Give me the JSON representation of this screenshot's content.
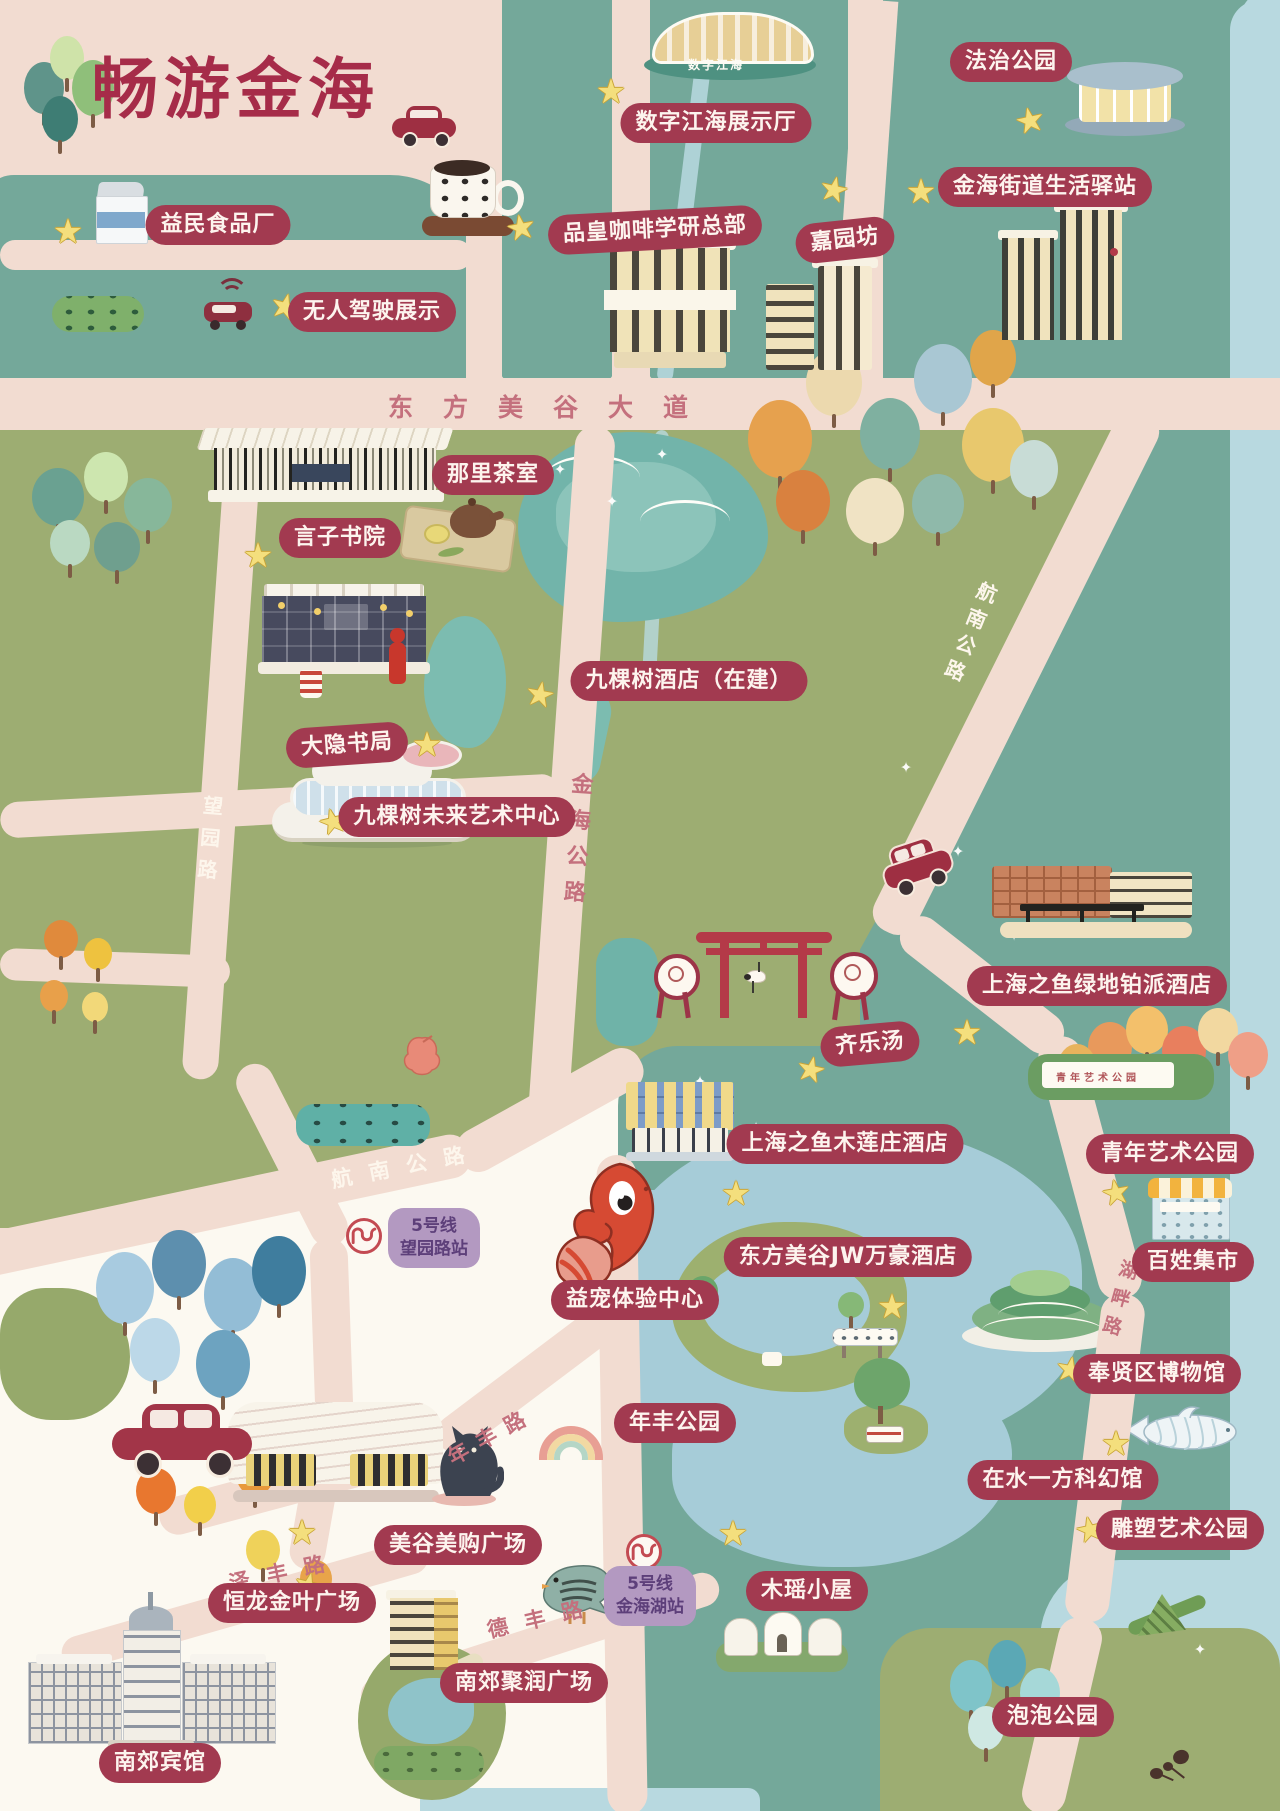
{
  "title": "畅游金海",
  "colors": {
    "background_pink": "#f2dcd1",
    "block_teal": "#74a89a",
    "block_olive": "#9dad72",
    "water_light": "#b8d9e0",
    "lake_blue": "#a6ccd8",
    "label_red": "#a23a50",
    "label_text": "#fdf4ee",
    "road_text_red": "#c4707d",
    "road_text_white": "#fdf6ec",
    "star_yellow": "#f4df7d",
    "metro_purple": "#b399c1",
    "title_red": "#a62c49"
  },
  "icons": {
    "star": "★",
    "sparkle": "✦"
  },
  "pois": {
    "yimin": "益民食品厂",
    "wuren": "无人驾驶展示",
    "shuzi": "数字江海展示厅",
    "pinhuang": "品皇咖啡学研总部",
    "jiayuanfang": "嘉园坊",
    "fazhi": "法治公园",
    "yizhan": "金海街道生活驿站",
    "nali": "那里茶室",
    "yanzi": "言子书院",
    "jiukeshu_hotel": "九棵树酒店（在建）",
    "dayin": "大隐书局",
    "jiukeshu_art": "九棵树未来艺术中心",
    "lvdi_hotel": "上海之鱼绿地铂派酒店",
    "qiletang": "齐乐汤",
    "mulianzhuang": "上海之鱼木莲庄酒店",
    "jw": "东方美谷JW万豪酒店",
    "qingnian": "青年艺术公园",
    "baixing": "百姓集市",
    "yichong": "益宠体验中心",
    "bowuguan": "奉贤区博物馆",
    "nianfeng_park": "年丰公园",
    "kehuan": "在水一方科幻馆",
    "diaosu": "雕塑艺术公园",
    "meigou": "美谷美购广场",
    "henglong": "恒龙金叶广场",
    "jurun": "南郊聚润广场",
    "nanjiao_hotel": "南郊宾馆",
    "muyao": "木瑶小屋",
    "paopao": "泡泡公园"
  },
  "roads": {
    "meigu_avenue": "东方美谷大道",
    "jinhai": "金海公路",
    "hangnan_ne": "航南公路",
    "hangnan_sw": "航南公路",
    "wangyuan": "望园路",
    "nianfeng": "年丰路",
    "zefeng": "泽丰路",
    "defeng": "德丰路",
    "hupan": "湖畔路"
  },
  "metro": {
    "wangyuan": {
      "line": "5号线",
      "station": "望园路站"
    },
    "jinhaihu": {
      "line": "5号线",
      "station": "金海湖站"
    }
  },
  "signs": {
    "ds_hall": "数字江海",
    "youth_art_wall": "青年艺术公园"
  }
}
